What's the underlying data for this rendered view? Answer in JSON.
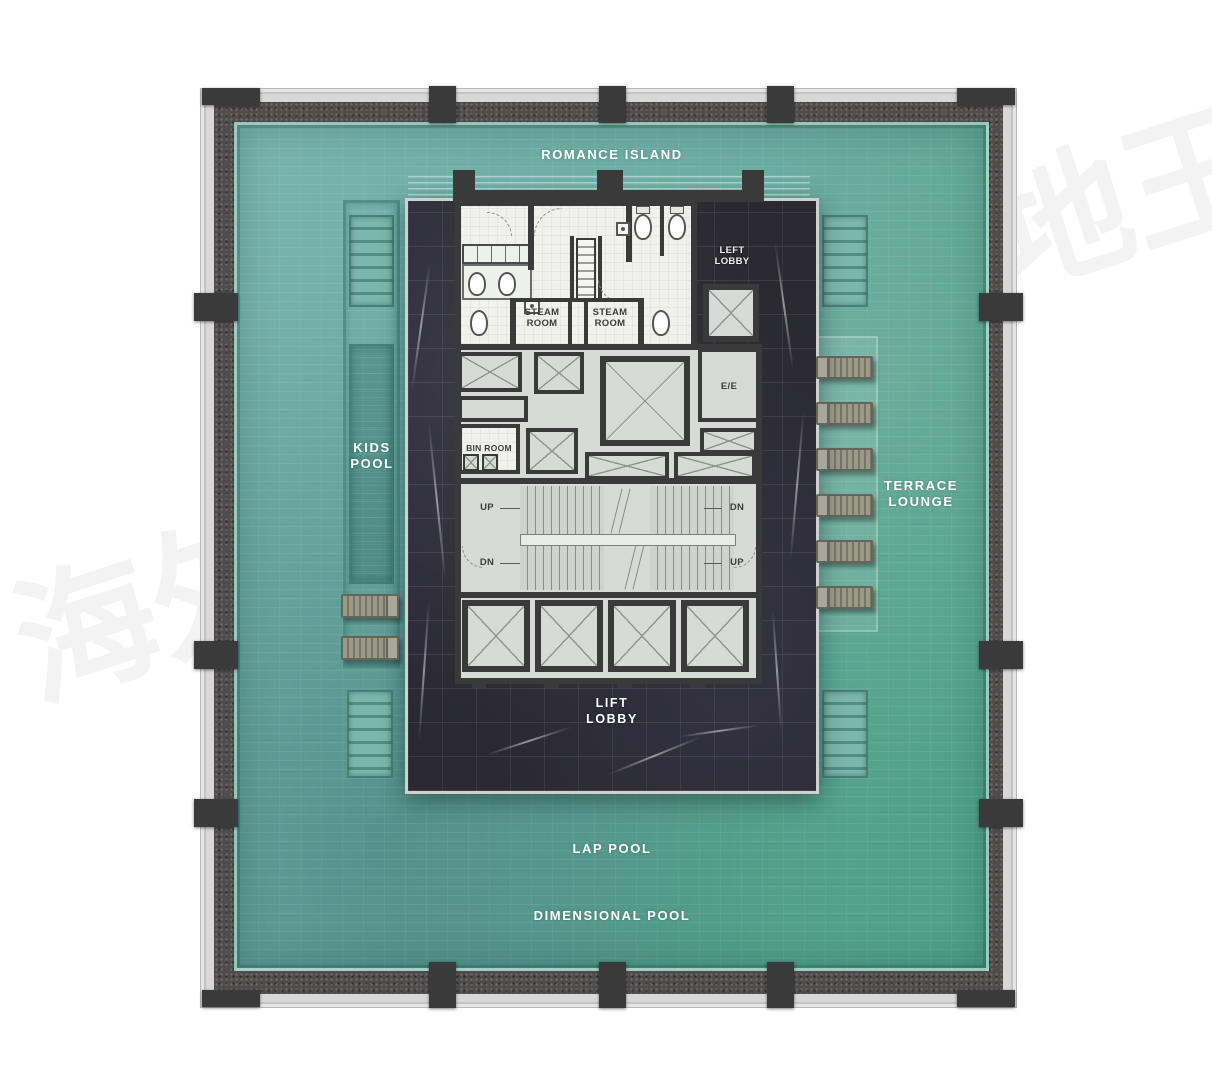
{
  "watermarks": {
    "top_right": "地王",
    "bottom_left": "海外"
  },
  "pool_labels": {
    "romance_island": "ROMANCE ISLAND",
    "kids_pool": "KIDS\nPOOL",
    "terrace_lounge": "TERRACE\nLOUNGE",
    "lift_lobby": "LIFT\nLOBBY",
    "lap_pool": "LAP POOL",
    "dimensional_pool": "DIMENSIONAL POOL"
  },
  "room_labels": {
    "left_lobby": "LEFT\nLOBBY",
    "steam_room_left": "STEAM\nROOM",
    "steam_room_right": "STEAM\nROOM",
    "bin_room": "BIN ROOM",
    "electrical": "E/E",
    "stair_up_top_left": "UP",
    "stair_dn_top_right": "DN",
    "stair_dn_bottom_left": "DN",
    "stair_up_bottom_right": "UP"
  },
  "colors": {
    "pool_teal": "#68aba1",
    "pool_deep": "#4da085",
    "pool_light": "#7ab5ae",
    "deck_dark": "#4f4c4c",
    "frame_light": "#d8d8d8",
    "marble_dark": "#2a2932",
    "wall_dark": "#3a3a3a",
    "floor_white": "#f1f2ee",
    "room_gray": "#d7dad6",
    "lounger_tan": "#9b9a89",
    "label_dark": "#3d3d3d"
  }
}
